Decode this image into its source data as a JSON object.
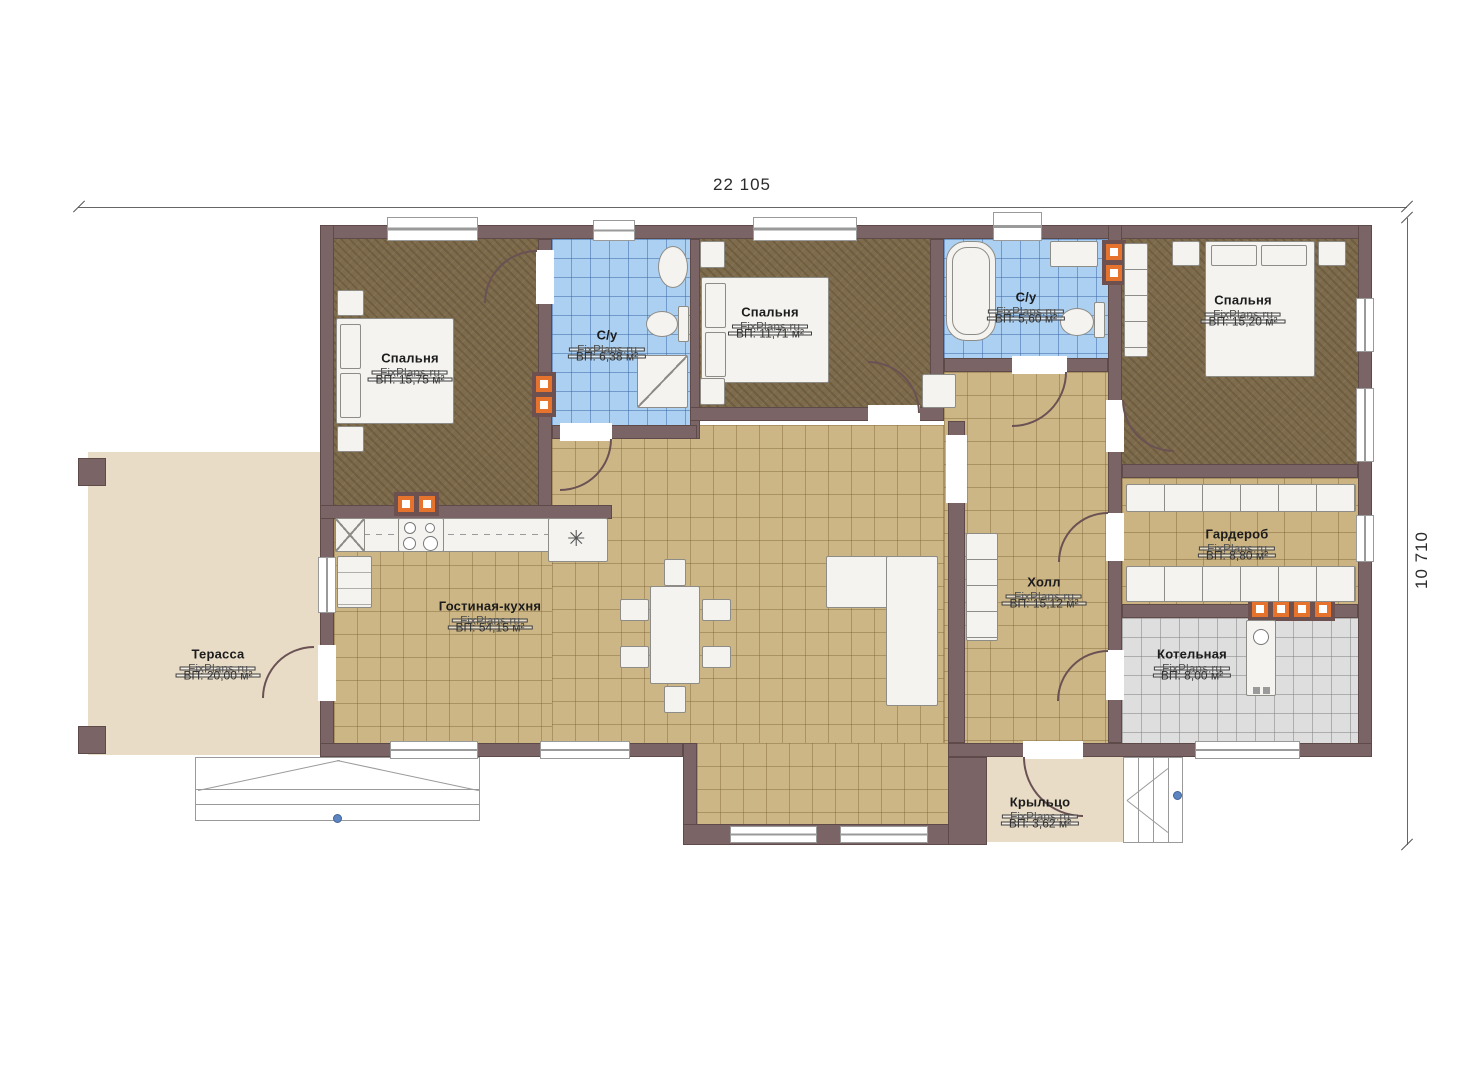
{
  "dimensions": {
    "width_label": "22 105",
    "height_label": "10 710"
  },
  "watermark": "FixPlans.ru",
  "symbols": {
    "kitchen_star": "✳"
  },
  "rooms": {
    "terrace": {
      "name": "Терасса",
      "area": "ВП: 20,00 м²"
    },
    "bedroom1": {
      "name": "Спальня",
      "area": "ВП: 15,75 м²"
    },
    "bathroom1": {
      "name": "С/у",
      "area": "ВП: 6,38 м²"
    },
    "bedroom2": {
      "name": "Спальня",
      "area": "ВП: 11,71 м²"
    },
    "bathroom2": {
      "name": "С/у",
      "area": "ВП: 5,60 м²"
    },
    "bedroom3": {
      "name": "Спальня",
      "area": "ВП: 15,20 м²"
    },
    "wardrobe": {
      "name": "Гардероб",
      "area": "ВП: 8,80 м²"
    },
    "hall": {
      "name": "Холл",
      "area": "ВП: 15,12 м²"
    },
    "boiler": {
      "name": "Котельная",
      "area": "ВП: 8,00 м²"
    },
    "living": {
      "name": "Гостиная-кухня",
      "area": "ВП: 54,15 м²"
    },
    "porch": {
      "name": "Крыльцо",
      "area": "ВП: 3,62 м²"
    }
  },
  "colors": {
    "wall": "#7b6465",
    "floor_wood": "#7d6b4c",
    "floor_tile_tan": "#cdb685",
    "floor_tile_blue": "#abd0f1",
    "floor_tile_gray": "#dedede",
    "terrace": "#e8dcc7",
    "vent_orange": "#e5732e",
    "accent_dot": "#5d86c0"
  }
}
